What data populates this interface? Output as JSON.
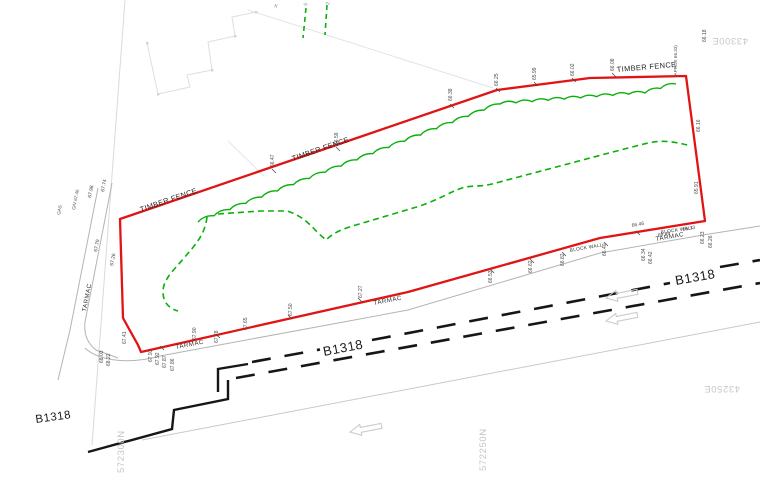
{
  "plan": {
    "fence_label": "TIMBER FENCE",
    "tarmac_label": "TARMAC",
    "block_wall_label": "BLOCK WALL",
    "road_name": "B1318",
    "approx_note": "(APROX 66.33)",
    "gas_label": "GAS",
    "gas_valve_label": "G/V 67.46",
    "grid_labels": {
      "northing_1": "572300N",
      "northing_2": "572250N",
      "easting_1": "43300E",
      "easting_2": "43250E"
    },
    "partial_top_labels": [
      "K",
      "5",
      "2"
    ],
    "spot_levels": [
      "66.38",
      "66.25",
      "65.99",
      "66.02",
      "66.08",
      "66.47",
      "66.59",
      "66.16",
      "65.91",
      "66.18",
      "66.46",
      "66.49",
      "66.23",
      "66.26",
      "66.34",
      "66.42",
      "66.53",
      "66.62",
      "66.82",
      "66.40",
      "67.27",
      "67.50",
      "67.65",
      "67.78",
      "67.90",
      "67.93",
      "67.92",
      "67.87",
      "67.86",
      "68.03",
      "68.22",
      "67.98",
      "67.74",
      "67.79",
      "67.26",
      "67.41",
      "66.33"
    ]
  }
}
